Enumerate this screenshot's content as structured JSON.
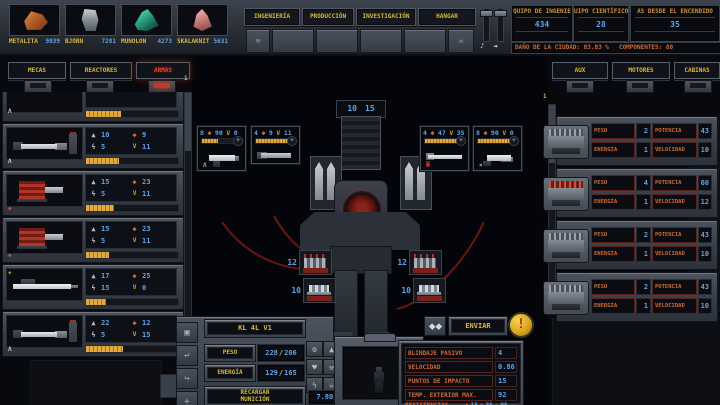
{
  "icons": {
    "music": "♪",
    "speaker": "◄",
    "wrench": "⚒",
    "alien": "☠",
    "weight": "▲",
    "energy": "ϟ",
    "damage": "◆",
    "ammo": "V",
    "plus": "+",
    "caret": "Λ",
    "cross": "×",
    "down": "▼",
    "gear": "⚙",
    "kettlebell": "▲",
    "shield": "♥",
    "spanner": "⚒",
    "bolt": "ϟ",
    "skull": "☠",
    "undo": "↩",
    "redo": "↪",
    "move": "+",
    "rec": "▣",
    "heat": "◆",
    "cold": "❄",
    "toxic": "☠",
    "warning": "!",
    "sep": "/"
  },
  "top_bar": {
    "resources": [
      {
        "name": "METALITA",
        "value": "9039"
      },
      {
        "name": "BJORN",
        "value": "7281"
      },
      {
        "name": "MUNOLON",
        "value": "4273"
      },
      {
        "name": "SKALAKNIT",
        "value": "5631"
      }
    ],
    "tabs": [
      {
        "label": "INGENIERÍA"
      },
      {
        "label": "PRODUCCIÓN"
      },
      {
        "label": "INVESTIGACIÓN"
      },
      {
        "label": "HANGAR"
      }
    ],
    "info_boxes": [
      {
        "label": "QUIPO DE INGENIE",
        "value": "434"
      },
      {
        "label": "UIPO CIENTÍFICO",
        "value": "28"
      },
      {
        "label": "AS DESDE EL ENCENDIDO",
        "value": "35"
      }
    ],
    "status_damage": "DAÑO DE LA CIUDAD: 83.83 %",
    "status_components": "COMPONENTES: 80"
  },
  "left_panel": {
    "tabs": [
      {
        "label": "MECAS"
      },
      {
        "label": "REACTORES"
      },
      {
        "label": "ARMAS"
      }
    ],
    "active_tab": "ARMAS",
    "scroll_index": "1",
    "items": [
      {
        "weight": "10",
        "energy": "5",
        "damage": "9",
        "ammo": "11"
      },
      {
        "weight": "15",
        "energy": "5",
        "damage": "23",
        "ammo": "11"
      },
      {
        "weight": "15",
        "energy": "5",
        "damage": "23",
        "ammo": "11"
      },
      {
        "weight": "17",
        "energy": "15",
        "damage": "25",
        "ammo": "0"
      },
      {
        "weight": "22",
        "energy": "5",
        "damage": "12",
        "ammo": "15"
      }
    ]
  },
  "right_panel": {
    "tabs": [
      {
        "label": "AUX"
      },
      {
        "label": "MOTORES"
      },
      {
        "label": "CABINAS"
      }
    ],
    "scroll_index": "1",
    "labels": {
      "peso": "PESO",
      "potencia": "POTENCIA",
      "energia": "ENERGÍA",
      "velocidad": "VELOCIDAD"
    },
    "items": [
      {
        "peso": "2",
        "potencia": "43",
        "energia": "1",
        "velocidad": "10"
      },
      {
        "peso": "4",
        "potencia": "60",
        "energia": "1",
        "velocidad": "12"
      },
      {
        "peso": "2",
        "potencia": "43",
        "energia": "1",
        "velocidad": "10"
      },
      {
        "peso": "2",
        "potencia": "43",
        "energia": "1",
        "velocidad": "10"
      }
    ]
  },
  "mech": {
    "top_ammo_left": "10",
    "top_ammo_right": "15",
    "slots": [
      {
        "stat": "8",
        "damage": "90",
        "ammo": "0"
      },
      {
        "stat": "4",
        "damage": "9",
        "ammo": "11"
      },
      {
        "stat": "4",
        "damage": "47",
        "ammo": "35"
      },
      {
        "stat": "8",
        "damage": "90",
        "ammo": "0"
      }
    ],
    "crates": [
      {
        "count": "12"
      },
      {
        "count": "10"
      },
      {
        "count": "12"
      },
      {
        "count": "10"
      }
    ]
  },
  "footer": {
    "mech_name": "KL 4L V1",
    "peso_label": "PESO",
    "peso_value": "228",
    "peso_max": "206",
    "energia_label": "ENERGÍA",
    "energia_value": "129",
    "energia_max": "165",
    "reload_line1": "RECARGAR",
    "reload_line2": "MUNICIÓN",
    "reload_value": "7.80/9",
    "send_label": "ENVIAR",
    "stats": [
      {
        "label": "BLINDAJE PASIVO",
        "value": "4"
      },
      {
        "label": "VELOCIDAD",
        "value": "0.86"
      },
      {
        "label": "PUNTOS DE IMPACTO",
        "value": "15"
      },
      {
        "label": "TEMP. EXTERIOR MAX.",
        "value": "92"
      }
    ],
    "resist_label": "RESISTENCIAS",
    "resists": [
      {
        "value": "15"
      },
      {
        "value": "35"
      },
      {
        "value": "95"
      }
    ]
  }
}
